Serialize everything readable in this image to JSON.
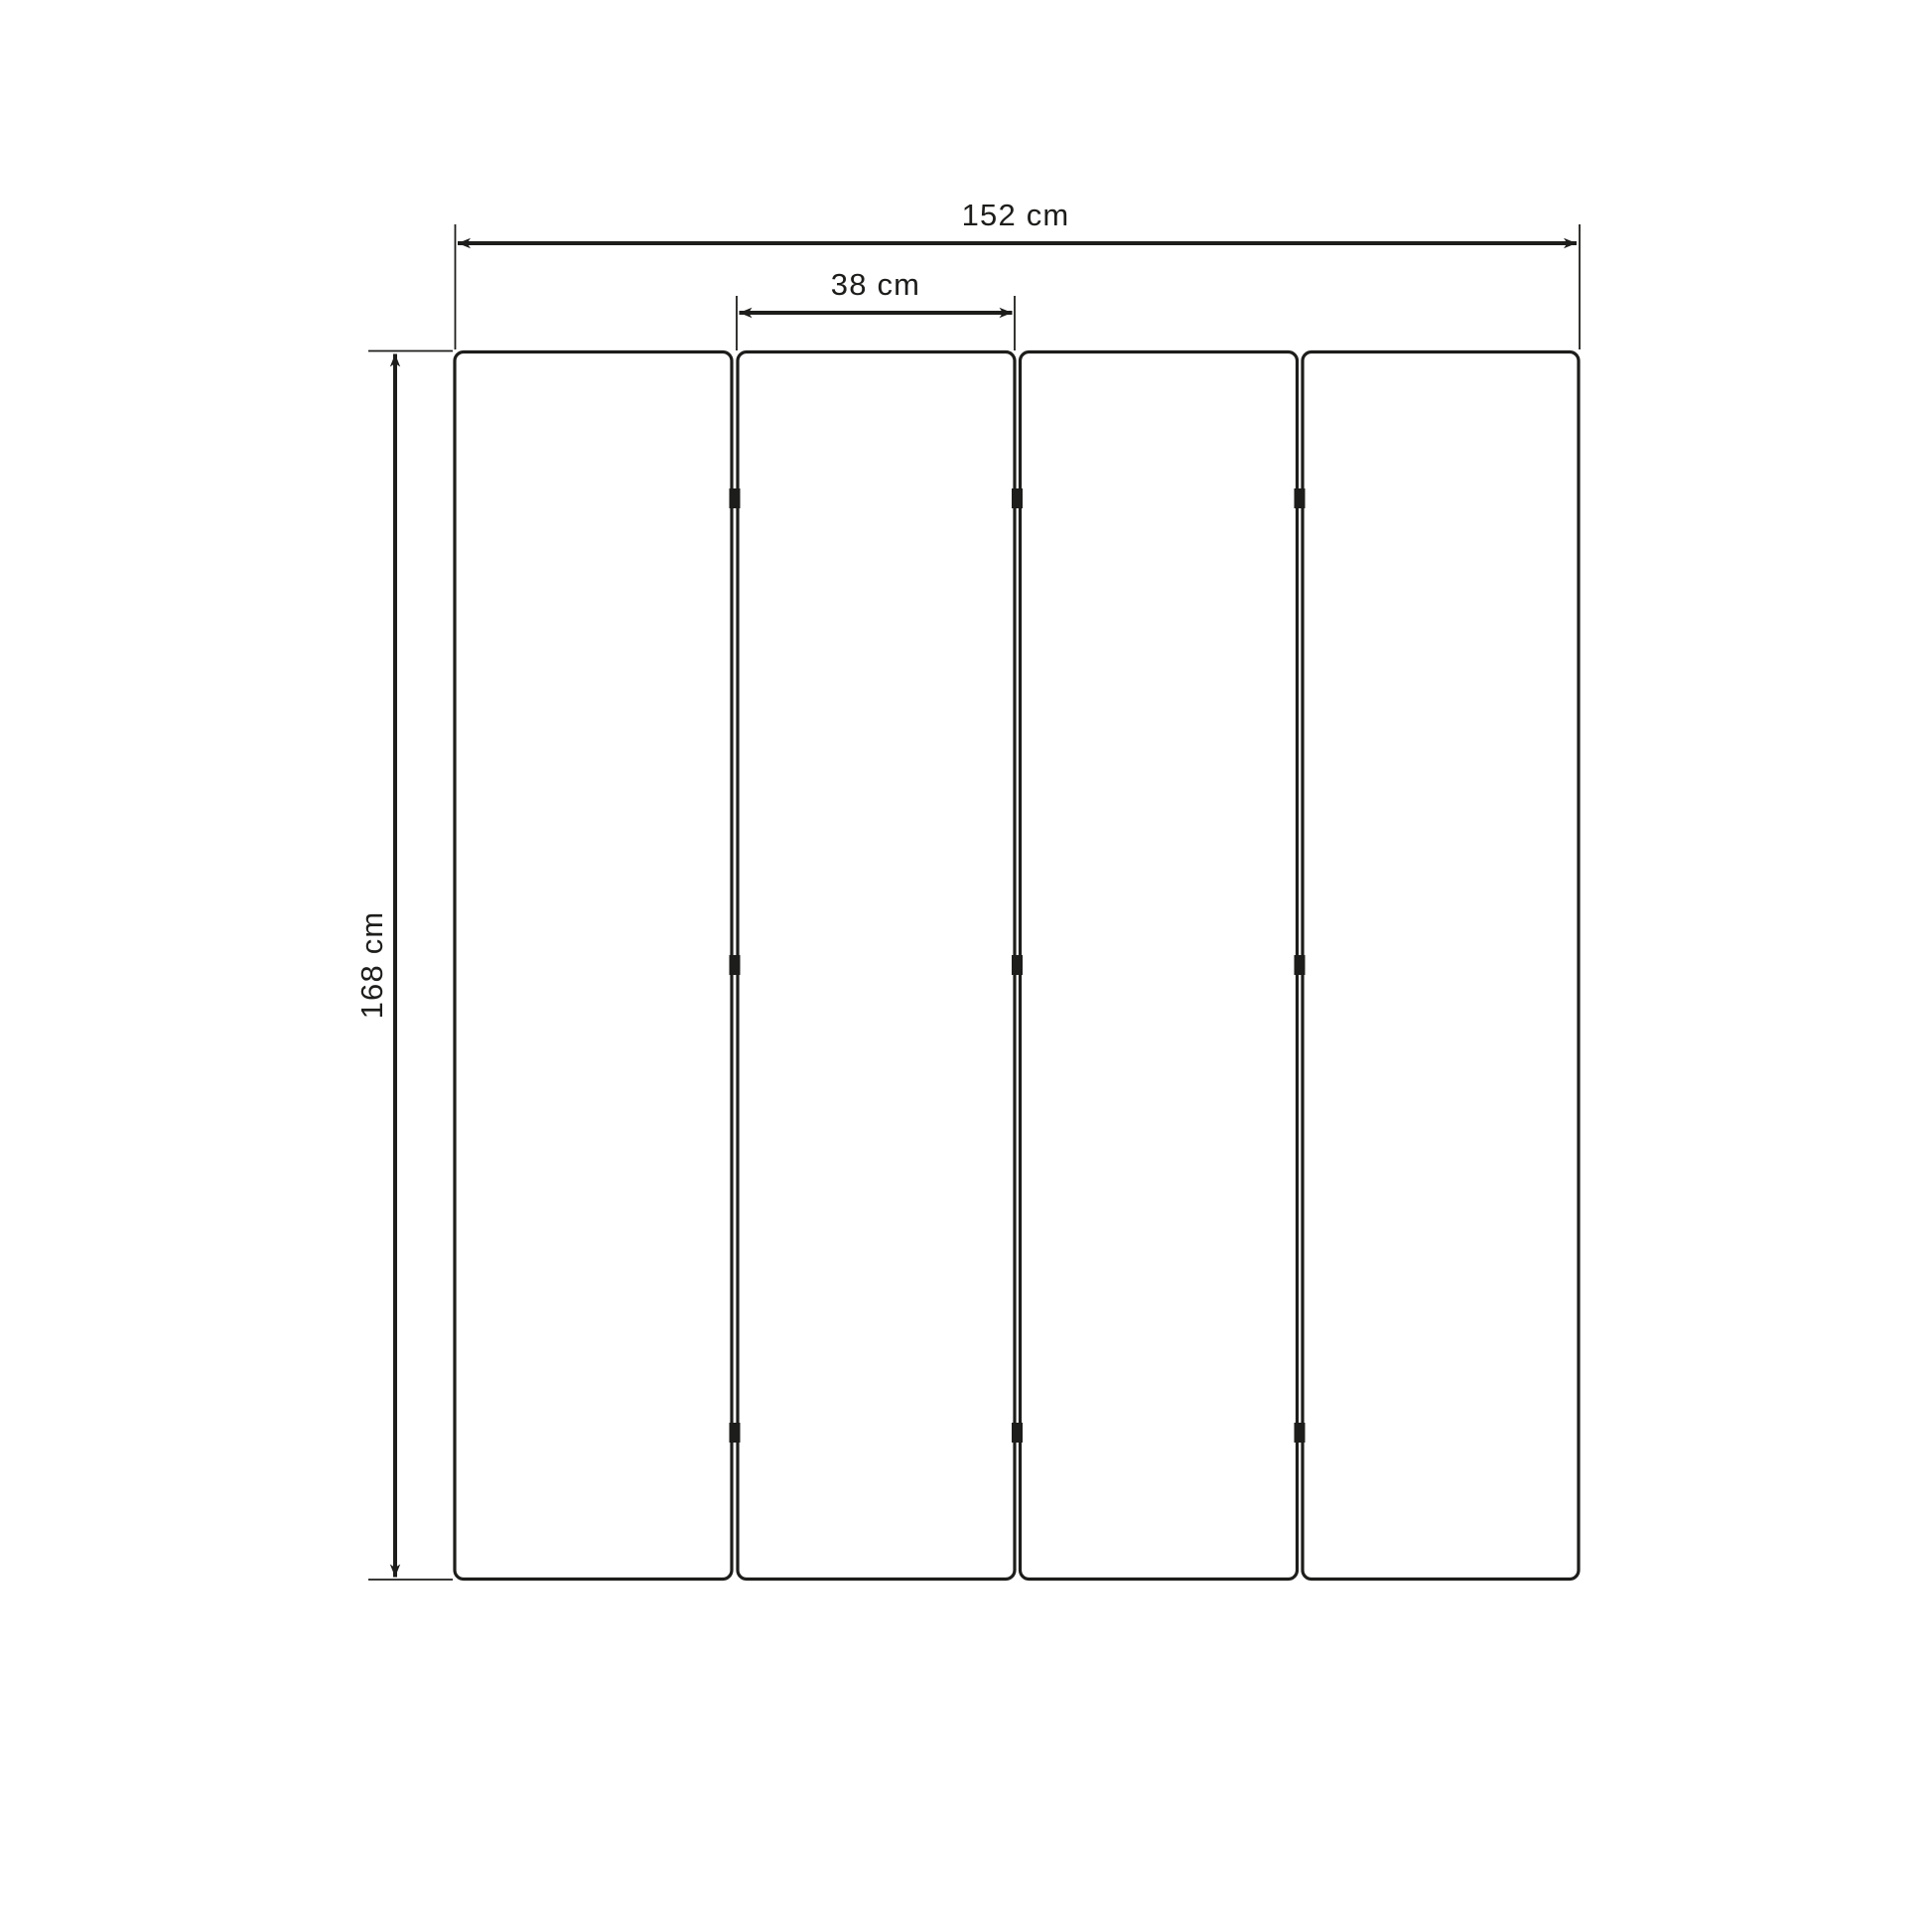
{
  "page": {
    "background_color": "#ffffff",
    "line_color": "#1d1d1b"
  },
  "diagram": {
    "type": "product-dimension-drawing",
    "subject": "four-panel folding screen, front elevation",
    "panel_count": 4,
    "hinge_rows_per_gap": 3,
    "dimensions": {
      "total_width": {
        "value": 152,
        "unit": "cm",
        "label": "152 cm"
      },
      "panel_width": {
        "value": 38,
        "unit": "cm",
        "label": "38 cm"
      },
      "height": {
        "value": 168,
        "unit": "cm",
        "label": "168 cm"
      }
    }
  }
}
